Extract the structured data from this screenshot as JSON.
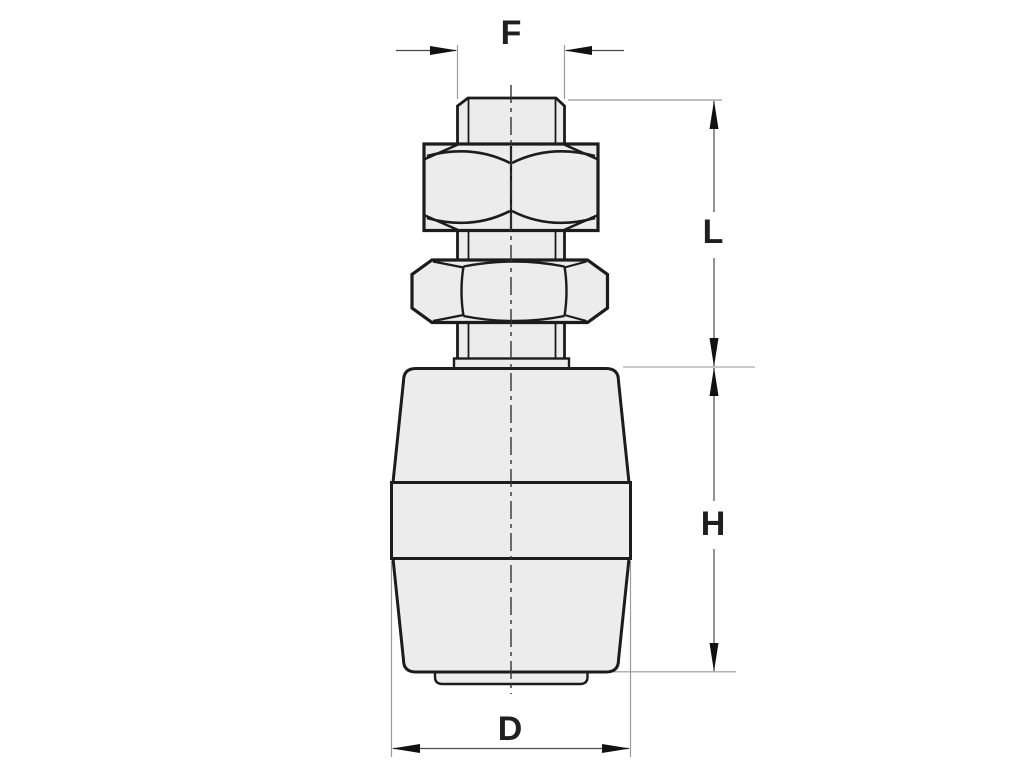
{
  "drawing": {
    "labels": {
      "top_width": "F",
      "upper_length": "L",
      "body_height": "H",
      "bottom_diameter": "D"
    }
  },
  "colors": {
    "background": "#ffffff",
    "part_fill": "#ececec",
    "outline": "#1c1c1c",
    "dimension_line": "#4a4a4a",
    "extension_line": "#9b9b9b",
    "arrow": "#111111",
    "centerline": "#333333",
    "label_text": "#1f1f1f"
  }
}
